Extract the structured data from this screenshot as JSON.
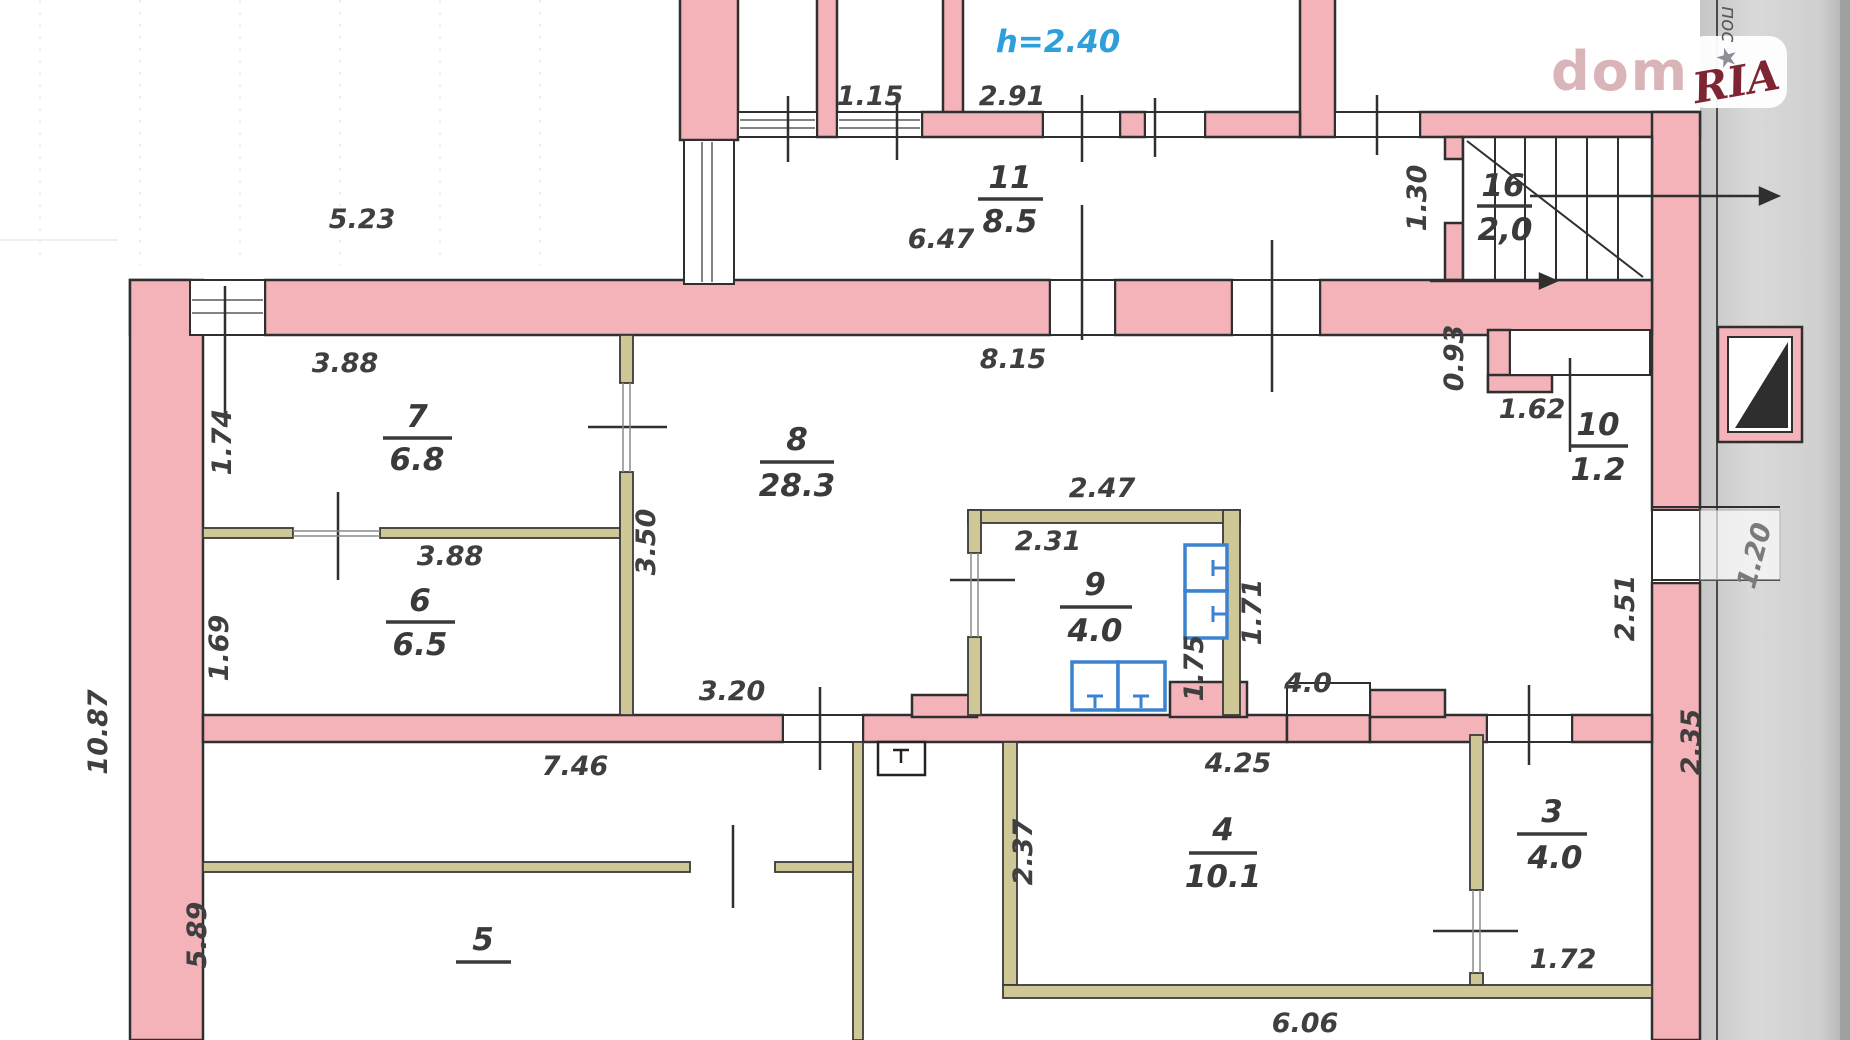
{
  "plan": {
    "height_note": "h=2.40",
    "rooms": [
      {
        "id": "room-11",
        "number": "11",
        "area": "8.5"
      },
      {
        "id": "room-16",
        "number": "16",
        "area": "2,0"
      },
      {
        "id": "room-7",
        "number": "7",
        "area": "6.8"
      },
      {
        "id": "room-8",
        "number": "8",
        "area": "28.3"
      },
      {
        "id": "room-9",
        "number": "9",
        "area": "4.0"
      },
      {
        "id": "room-10",
        "number": "10",
        "area": "1.2"
      },
      {
        "id": "room-6",
        "number": "6",
        "area": "6.5"
      },
      {
        "id": "room-4",
        "number": "4",
        "area": "10.1"
      },
      {
        "id": "room-3",
        "number": "3",
        "area": "4.0"
      },
      {
        "id": "room-5",
        "number": "5",
        "area": ""
      }
    ],
    "dims": {
      "d523": "5.23",
      "d115": "1.15",
      "d291": "2.91",
      "d647": "6.47",
      "d130": "1.30",
      "d815": "8.15",
      "d388a": "3.88",
      "d174": "1.74",
      "d388b": "3.88",
      "d169": "1.69",
      "d350": "3.50",
      "d247": "2.47",
      "d231": "2.31",
      "d171": "1.71",
      "d175": "1.75",
      "d093": "0.93",
      "d162": "1.62",
      "d251": "2.51",
      "d320": "3.20",
      "d746": "7.46",
      "d425": "4.25",
      "d40": "4.0",
      "d237": "2.37",
      "d235": "2.35",
      "d172": "1.72",
      "d606": "6.06",
      "d1087": "10.87",
      "d589": "5.89",
      "d120": "1.20"
    }
  },
  "watermark": {
    "brand_left": "dom",
    "brand_right": "RIA",
    "star": "★",
    "edge_text": "пос"
  },
  "colors": {
    "wall_fill": "#f3b3b8",
    "wall_outline": "#2f2f2f",
    "partition_fill": "#cfc896",
    "fixture_blue": "#3b82d0",
    "note_blue": "#2da0dc",
    "ria_red": "#7d2533",
    "dom_pink": "#d9b4b8",
    "text_dark": "#3f3f3f"
  }
}
